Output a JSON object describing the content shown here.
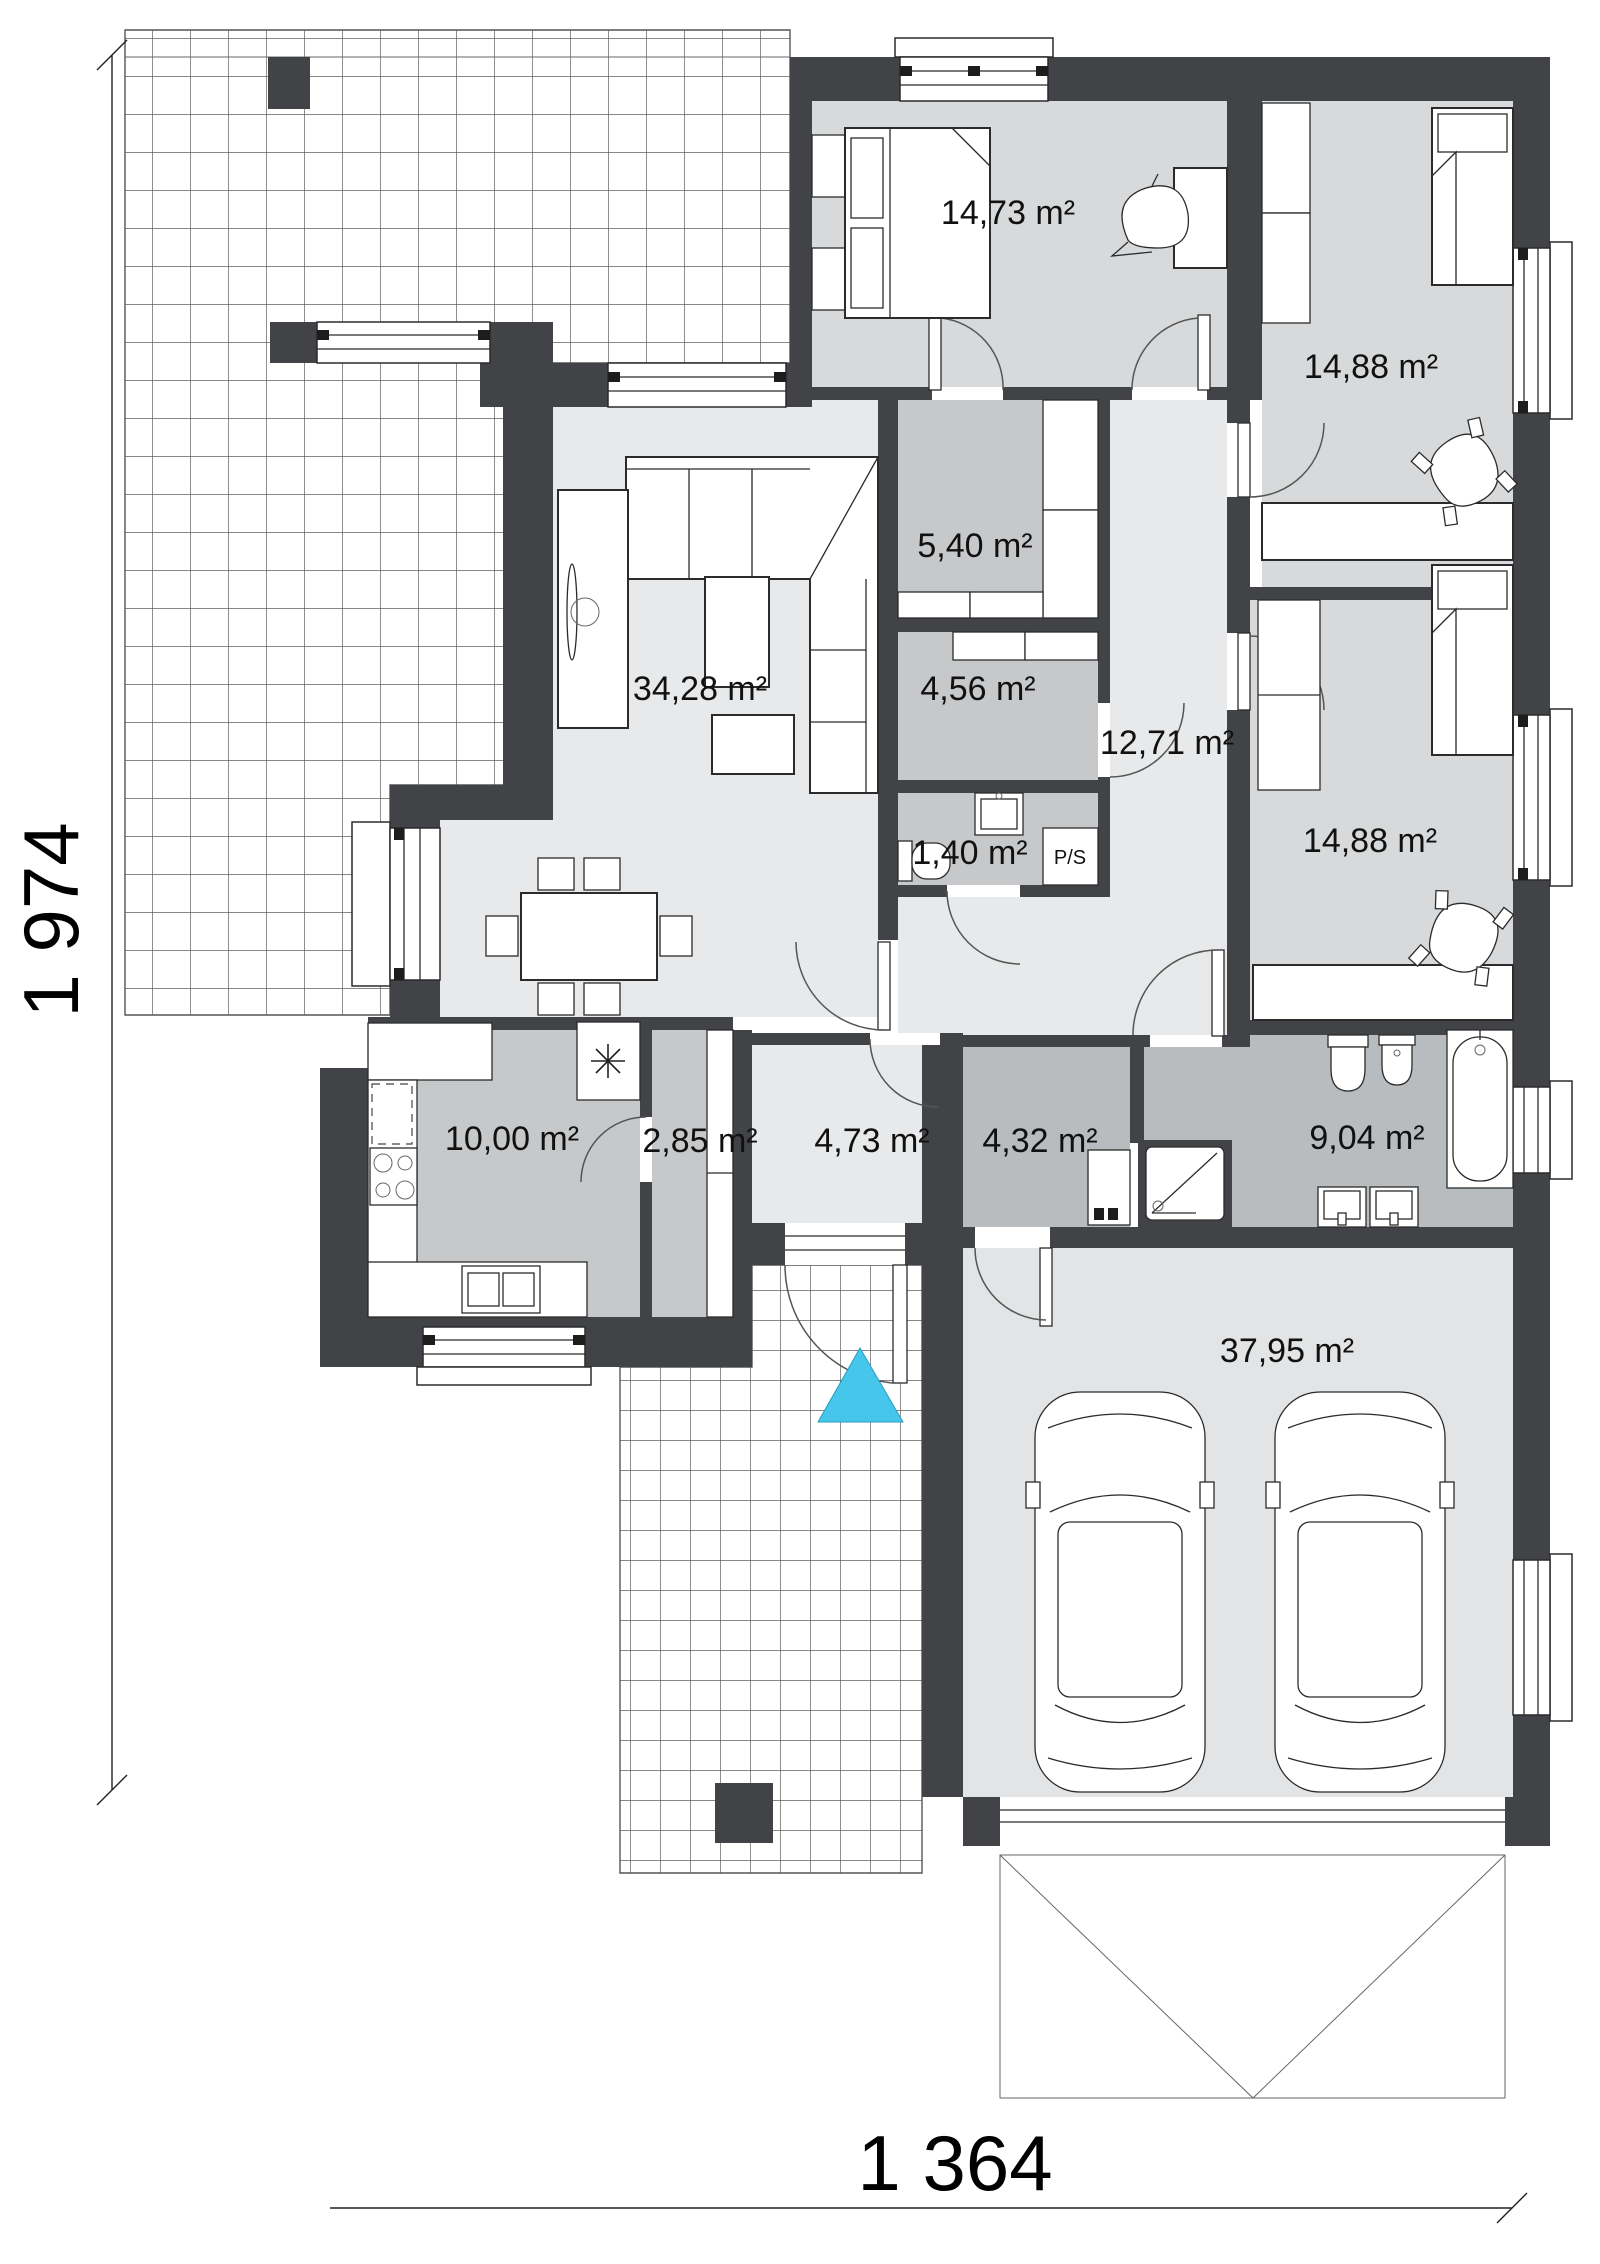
{
  "drawing": {
    "type": "house floor plan",
    "colors": {
      "wall": "#414346",
      "floor_light": "#e8e9ea",
      "floor_bedroom": "#d7d9da",
      "floor_mid": "#c6c8ca",
      "floor_dark": "#b9bcbf",
      "floor_garage": "#e3e4e5",
      "entrance_marker": "#45c6ea"
    },
    "rooms": [
      {
        "id": "living",
        "label": "34,28 m²"
      },
      {
        "id": "bedroom",
        "label": "14,73 m²"
      },
      {
        "id": "child1",
        "label": "14,88 m²"
      },
      {
        "id": "wardrobe",
        "label": "5,40 m²"
      },
      {
        "id": "storage",
        "label": "4,56 m²"
      },
      {
        "id": "corridor",
        "label": "12,71 m²"
      },
      {
        "id": "wc",
        "label": "1,40 m²"
      },
      {
        "id": "child2",
        "label": "14,88 m²"
      },
      {
        "id": "kitchen",
        "label": "10,00 m²"
      },
      {
        "id": "pantry",
        "label": "2,85 m²"
      },
      {
        "id": "hall",
        "label": "4,73 m²"
      },
      {
        "id": "utility",
        "label": "4,32 m²"
      },
      {
        "id": "bathroom",
        "label": "9,04 m²"
      },
      {
        "id": "garage",
        "label": "37,95 m²"
      }
    ],
    "closet_label": "P/S",
    "dimensions": {
      "height_label": "1 974",
      "width_label": "1 364"
    }
  }
}
